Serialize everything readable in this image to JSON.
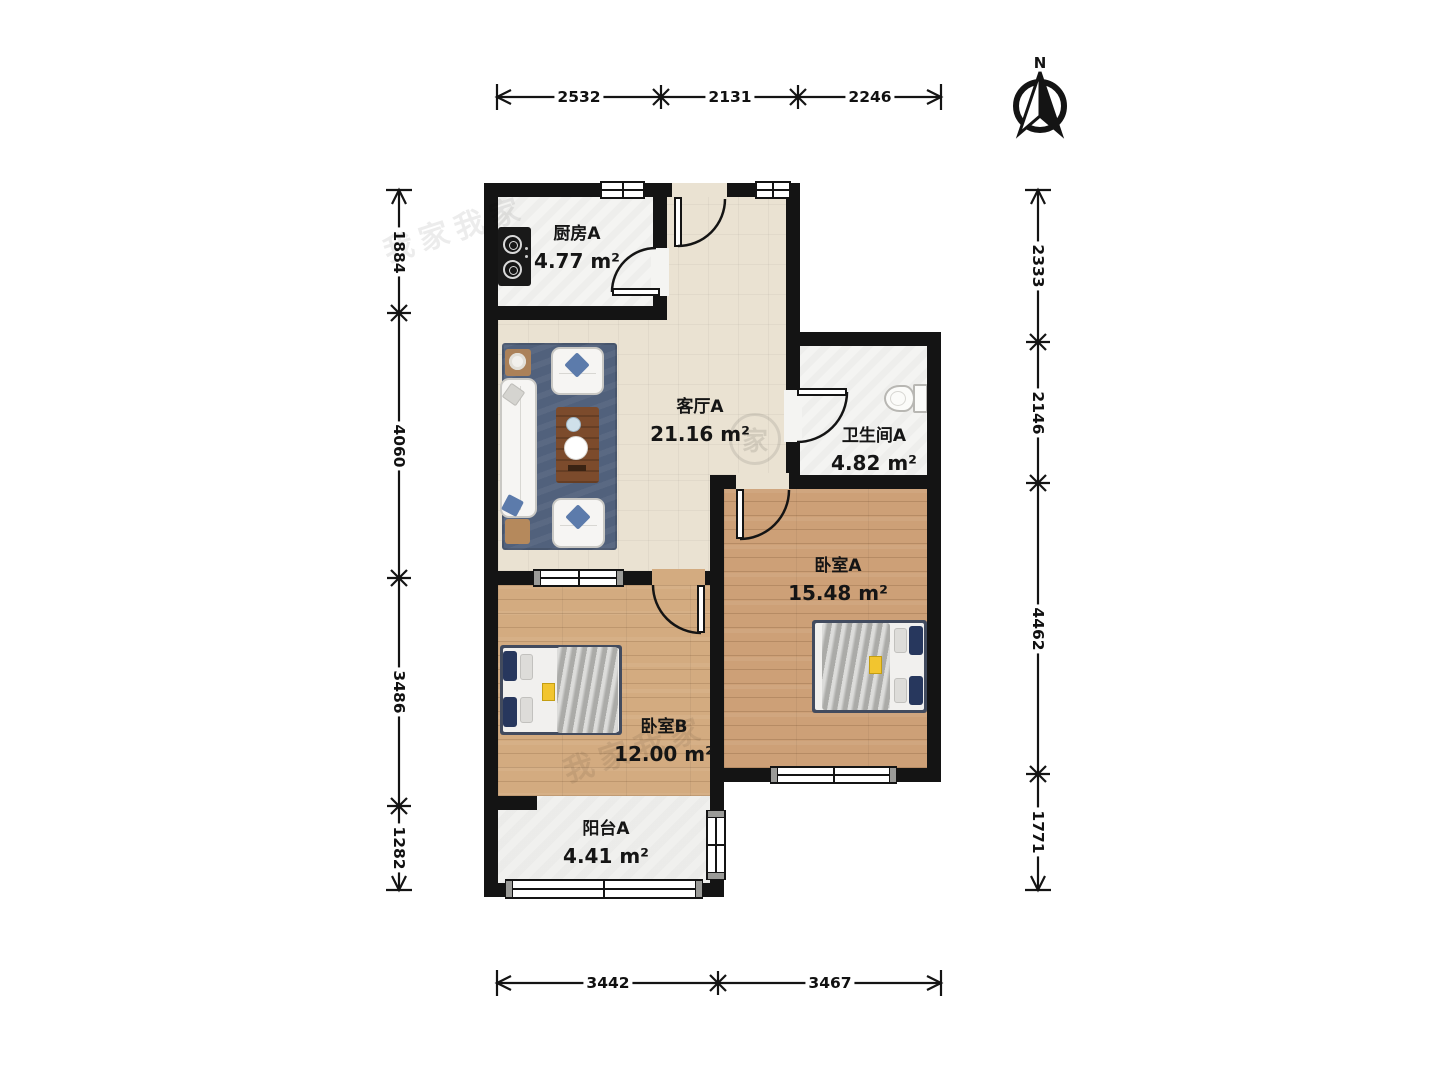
{
  "compass": {
    "label": "N"
  },
  "rooms": {
    "kitchen": {
      "name": "厨房A",
      "area": "4.77 m²"
    },
    "living": {
      "name": "客厅A",
      "area": "21.16 m²"
    },
    "bathroom": {
      "name": "卫生间A",
      "area": "4.82 m²"
    },
    "bedroomA": {
      "name": "卧室A",
      "area": "15.48 m²"
    },
    "bedroomB": {
      "name": "卧室B",
      "area": "12.00 m²"
    },
    "balcony": {
      "name": "阳台A",
      "area": "4.41 m²"
    }
  },
  "dimensions": {
    "top": [
      "2532",
      "2131",
      "2246"
    ],
    "bottom": [
      "3442",
      "3467"
    ],
    "left": [
      "1884",
      "4060",
      "3486",
      "1282"
    ],
    "right": [
      "2333",
      "2146",
      "4462",
      "1771"
    ]
  },
  "watermark": {
    "text": "我家我家",
    "stamp": "家"
  },
  "colors": {
    "wall": "#141414",
    "living_floor": "#eae2d2",
    "wood_floor_a": "#cda077",
    "wood_floor_b": "#d3ab80",
    "tile_floor": "#f4f4f2",
    "rug": "#51617c"
  }
}
